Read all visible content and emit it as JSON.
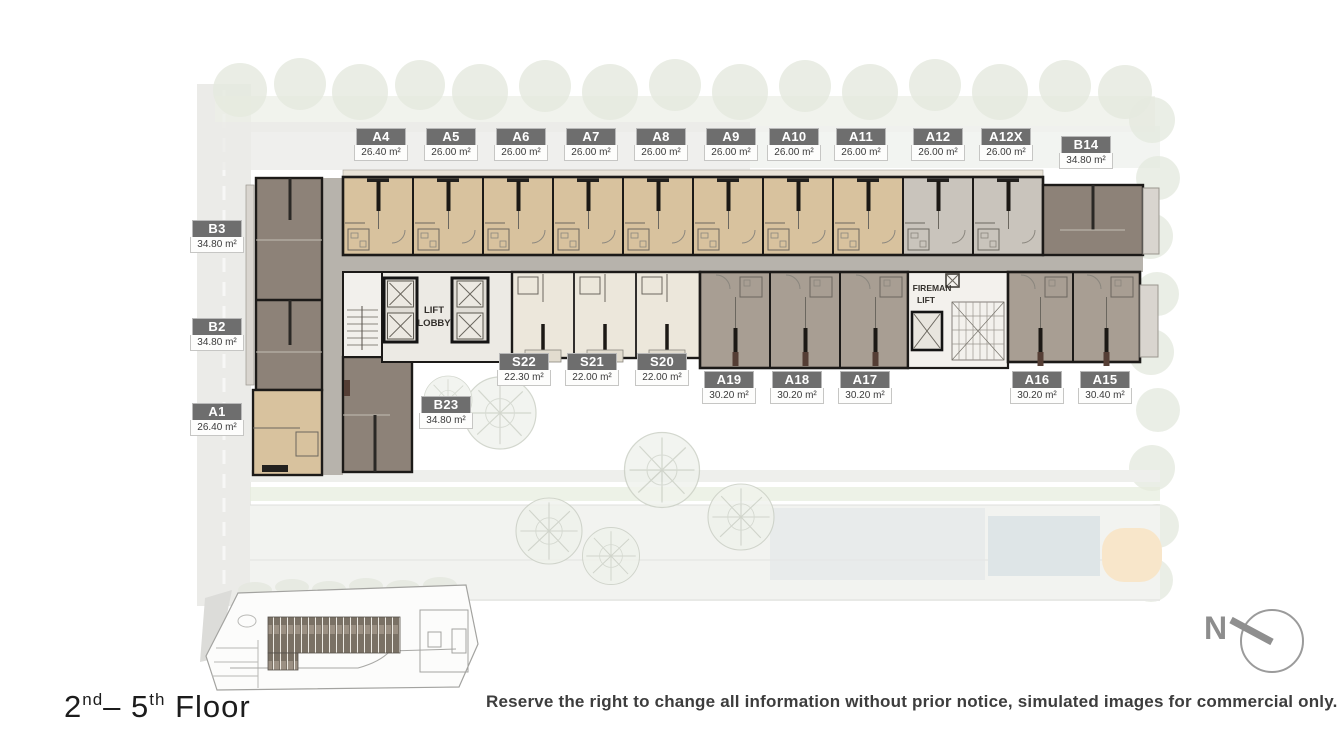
{
  "labels": {
    "a4": {
      "name": "A4",
      "area": "26.40 m²"
    },
    "a5": {
      "name": "A5",
      "area": "26.00 m²"
    },
    "a6": {
      "name": "A6",
      "area": "26.00 m²"
    },
    "a7": {
      "name": "A7",
      "area": "26.00 m²"
    },
    "a8": {
      "name": "A8",
      "area": "26.00 m²"
    },
    "a9": {
      "name": "A9",
      "area": "26.00 m²"
    },
    "a10": {
      "name": "A10",
      "area": "26.00 m²"
    },
    "a11": {
      "name": "A11",
      "area": "26.00 m²"
    },
    "a12": {
      "name": "A12",
      "area": "26.00 m²"
    },
    "a12x": {
      "name": "A12X",
      "area": "26.00 m²"
    },
    "b14": {
      "name": "B14",
      "area": "34.80 m²"
    },
    "b3": {
      "name": "B3",
      "area": "34.80 m²"
    },
    "b2": {
      "name": "B2",
      "area": "34.80 m²"
    },
    "a1": {
      "name": "A1",
      "area": "26.40 m²"
    },
    "s22": {
      "name": "S22",
      "area": "22.30 m²"
    },
    "s21": {
      "name": "S21",
      "area": "22.00 m²"
    },
    "s20": {
      "name": "S20",
      "area": "22.00 m²"
    },
    "b23": {
      "name": "B23",
      "area": "34.80 m²"
    },
    "a19": {
      "name": "A19",
      "area": "30.20 m²"
    },
    "a18": {
      "name": "A18",
      "area": "30.20 m²"
    },
    "a17": {
      "name": "A17",
      "area": "30.20 m²"
    },
    "a16": {
      "name": "A16",
      "area": "30.20 m²"
    },
    "a15": {
      "name": "A15",
      "area": "30.40 m²"
    }
  },
  "plan_texts": {
    "lift_line1": "LIFT",
    "lift_line2": "LOBBY",
    "fireman_line1": "FIREMAN",
    "fireman_line2": "LIFT"
  },
  "compass": {
    "north_label": "N"
  },
  "footer": {
    "floor_num1": "2",
    "floor_sup1": "nd",
    "floor_sep": "– ",
    "floor_num2": "5",
    "floor_sup2": "th",
    "floor_word": " Floor",
    "disclaimer": "Reserve the right to change all information without prior notice, simulated images for commercial only."
  },
  "colors": {
    "unit_tan": "#d8c29e",
    "unit_gray": "#c9c4bc",
    "unit_taupe": "#8d8278",
    "unit_cream": "#ece7db",
    "unit_brown": "#a89e93",
    "corridor": "#b7b3ac",
    "label_header": "#6e6e6e"
  }
}
